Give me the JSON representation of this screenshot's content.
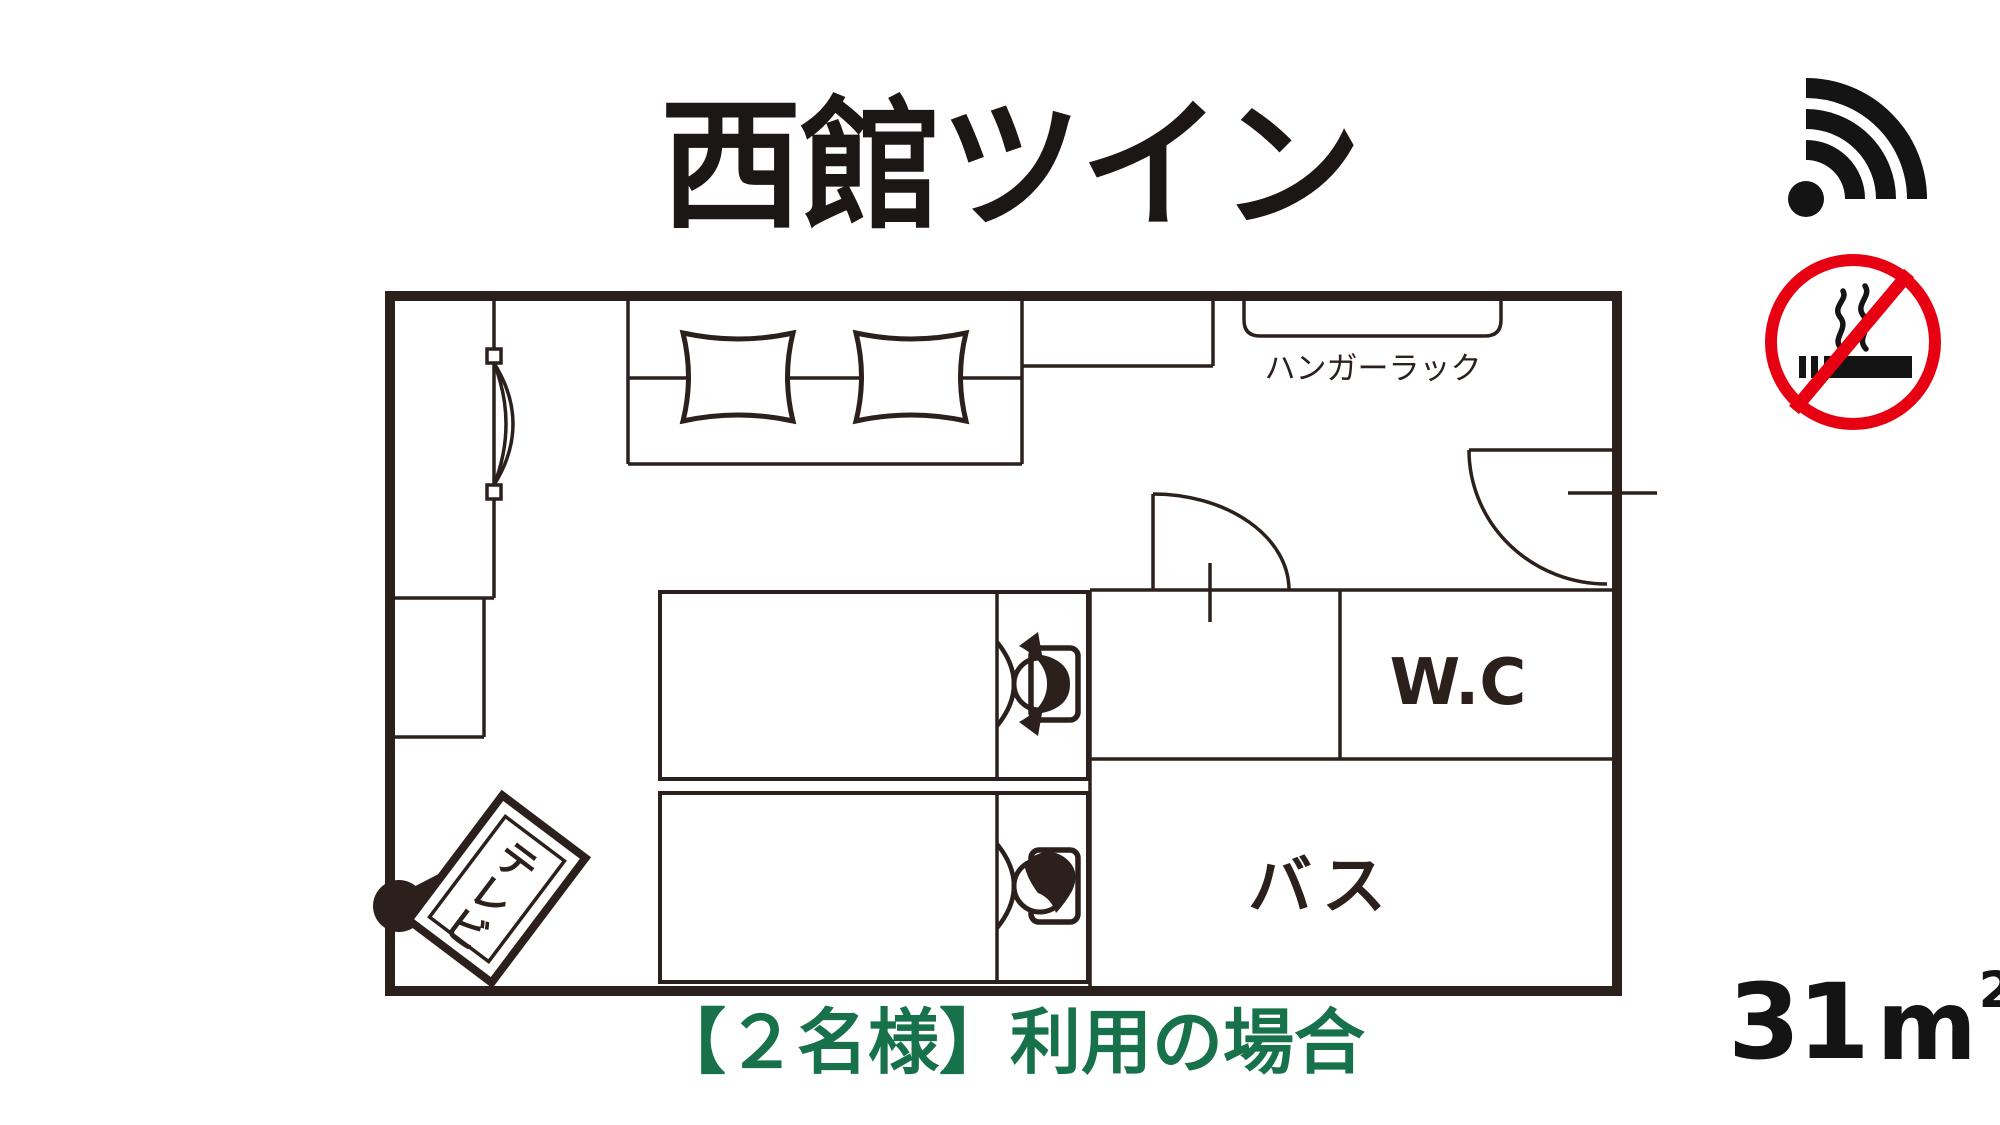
{
  "page": {
    "background": "#ffffff",
    "ink_color": "#2b201b",
    "title_color": "#1c1714",
    "green_color": "#17724b",
    "red_color": "#e60012"
  },
  "title": "西館ツイン",
  "caption": "【２名様】利用の場合",
  "area": {
    "value": "31",
    "unit": "m",
    "sup": "2"
  },
  "icons": {
    "wifi": "wifi-icon",
    "no_smoking": "no-smoking-icon"
  },
  "plan": {
    "labels": {
      "hanger_rack": "ハンガーラック",
      "wc": "W.C",
      "bath": "バス",
      "tv_chars": [
        "テ",
        "レ",
        "ビ"
      ]
    }
  }
}
